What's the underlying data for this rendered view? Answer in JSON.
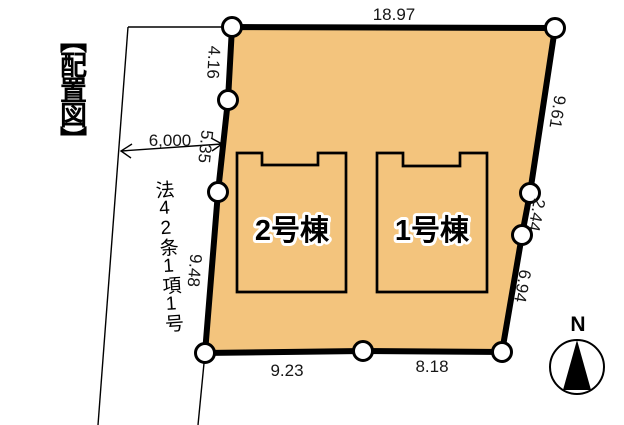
{
  "title": "【配置図】",
  "road": {
    "width_label": "6,000",
    "law_label": "法42条1項1号"
  },
  "parcel": {
    "fill_color": "#F3C47D",
    "line_color": "#000000",
    "dimensions": {
      "top": "18.97",
      "right_upper": "9.61",
      "right_middle": "2.44",
      "right_lower": "6.94",
      "bottom_right": "8.18",
      "bottom_left": "9.23",
      "left_upper": "4.16",
      "left_middle": "5.35",
      "left_lower": "9.48"
    }
  },
  "buildings": [
    {
      "label": "2号棟"
    },
    {
      "label": "1号棟"
    }
  ],
  "compass": {
    "north_label": "N"
  }
}
